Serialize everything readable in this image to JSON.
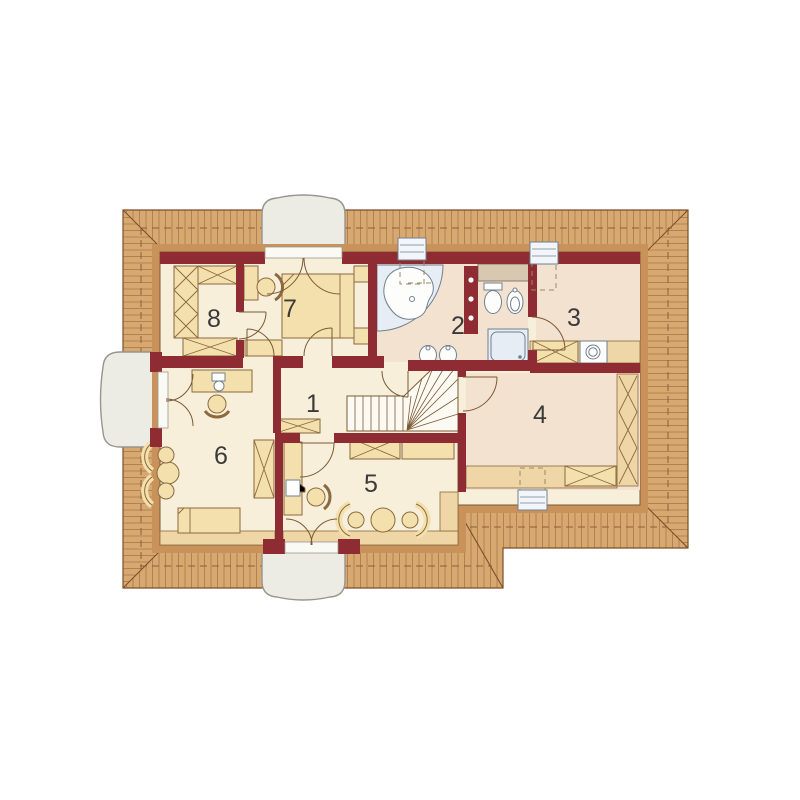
{
  "plan": {
    "kind": "attic floor plan",
    "rooms": [
      {
        "number": "1"
      },
      {
        "number": "2"
      },
      {
        "number": "3"
      },
      {
        "number": "4"
      },
      {
        "number": "5"
      },
      {
        "number": "6"
      },
      {
        "number": "7"
      },
      {
        "number": "8"
      }
    ],
    "fixtures": [
      "bathtub",
      "toilet",
      "bidet",
      "shower",
      "washbasin",
      "washbasin",
      "washing-machine"
    ],
    "furniture": [
      "bed",
      "bed",
      "wardrobe",
      "desk",
      "chair",
      "armchair",
      "table",
      "dresser",
      "shelf"
    ],
    "features": [
      "staircase",
      "dormer-window",
      "dormer-window",
      "dormer-window",
      "skylight",
      "skylight",
      "skylight"
    ]
  },
  "colors": {
    "wall": "#8E2B33",
    "roof": "#D7A971",
    "roof_line": "#7E4E28",
    "roof_dash": "#8A6036",
    "eave_band": "#C9925B",
    "floor": "#F7EFDA",
    "floor_warm": "#F3E2D0",
    "knee": "#EED6A6",
    "furniture": "#F4E0AC",
    "furniture_line": "#8A6A3E",
    "fixture_fill": "#E6EDF5",
    "fixture_line": "#708090",
    "dormer_fill": "#ECECE4",
    "dormer_line": "#96958E",
    "stair_fill": "#FCFAF3",
    "line": "#7A5A35",
    "label": "#3A3A3A"
  }
}
